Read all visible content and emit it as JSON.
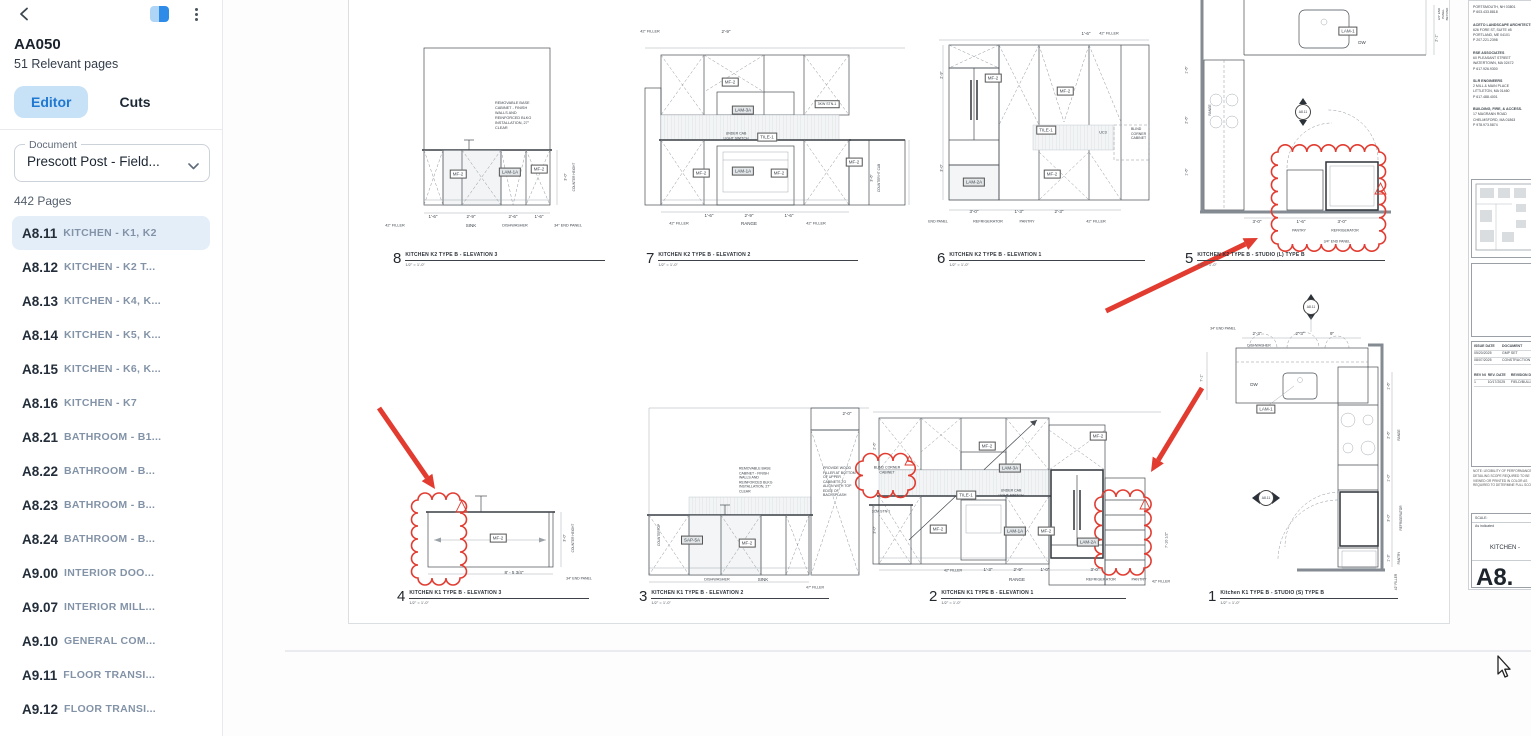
{
  "colors": {
    "accent": "#1f78d1",
    "tab_active_bg": "#c7e1f6",
    "selected_bg": "#e4eef9",
    "markup": "#e23b30",
    "line": "#464c52"
  },
  "sidebar": {
    "title": "AA050",
    "subtitle": "51 Relevant pages",
    "tabs": [
      {
        "label": "Editor",
        "active": true
      },
      {
        "label": "Cuts",
        "active": false
      }
    ],
    "document_label": "Document",
    "document_value": "Prescott Post - Field...",
    "pages_count": "442 Pages",
    "items": [
      {
        "code": "A8.11",
        "title": "KITCHEN - K1, K2",
        "selected": true
      },
      {
        "code": "A8.12",
        "title": "KITCHEN - K2 T...",
        "selected": false
      },
      {
        "code": "A8.13",
        "title": "KITCHEN - K4, K...",
        "selected": false
      },
      {
        "code": "A8.14",
        "title": "KITCHEN - K5, K...",
        "selected": false
      },
      {
        "code": "A8.15",
        "title": "KITCHEN - K6, K...",
        "selected": false
      },
      {
        "code": "A8.16",
        "title": "KITCHEN - K7",
        "selected": false
      },
      {
        "code": "A8.21",
        "title": "BATHROOM - B1...",
        "selected": false
      },
      {
        "code": "A8.22",
        "title": "BATHROOM - B...",
        "selected": false
      },
      {
        "code": "A8.23",
        "title": "BATHROOM - B...",
        "selected": false
      },
      {
        "code": "A8.24",
        "title": "BATHROOM - B...",
        "selected": false
      },
      {
        "code": "A9.00",
        "title": "INTERIOR DOO...",
        "selected": false
      },
      {
        "code": "A9.07",
        "title": "INTERIOR MILL...",
        "selected": false
      },
      {
        "code": "A9.10",
        "title": "GENERAL COM...",
        "selected": false
      },
      {
        "code": "A9.11",
        "title": "FLOOR TRANSI...",
        "selected": false
      },
      {
        "code": "A9.12",
        "title": "FLOOR TRANSI...",
        "selected": false
      },
      {
        "code": "A9.20",
        "title": "INTERIOR DET...",
        "selected": false
      }
    ]
  },
  "sheet": {
    "panels": [
      {
        "num": "8",
        "title": "KITCHEN K2 TYPE B - ELEVATION 3",
        "scale": "1/2\" = 1'-0\"",
        "x": 44,
        "y": 252,
        "w": 200
      },
      {
        "num": "7",
        "title": "KITCHEN K2 TYPE B - ELEVATION 2",
        "scale": "1/2\" = 1'-0\"",
        "x": 297,
        "y": 252,
        "w": 200
      },
      {
        "num": "6",
        "title": "KITCHEN K2 TYPE B - ELEVATION 1",
        "scale": "1/2\" = 1'-0\"",
        "x": 588,
        "y": 252,
        "w": 196
      },
      {
        "num": "5",
        "title": "KITCHEN K2 TYPE B - STUDIO (L) TYPE B",
        "scale": "1/2\" = 1'-0\"",
        "x": 836,
        "y": 252,
        "w": 188
      },
      {
        "num": "4",
        "title": "KITCHEN K1 TYPE B - ELEVATION 3",
        "scale": "1/2\" = 1'-0\"",
        "x": 48,
        "y": 590,
        "w": 180
      },
      {
        "num": "3",
        "title": "KITCHEN K1 TYPE B - ELEVATION 2",
        "scale": "1/2\" = 1'-0\"",
        "x": 290,
        "y": 590,
        "w": 178
      },
      {
        "num": "2",
        "title": "KITCHEN K1 TYPE B - ELEVATION 1",
        "scale": "1/2\" = 1'-0\"",
        "x": 580,
        "y": 590,
        "w": 185
      },
      {
        "num": "1",
        "title": "Kitchen K1 TYPE B - STUDIO (S) TYPE B",
        "scale": "1/2\" = 1'-0\"",
        "x": 859,
        "y": 590,
        "w": 178
      }
    ],
    "annotations": [
      {
        "t": "REMOVABLE BASE\nCABINET - FINISH\nWALLS AND\nREINFORCED BLKG\nINSTALLATION, 27\"\nCLEAR",
        "x": 146,
        "y": 116,
        "f": 3.8,
        "a": "l"
      },
      {
        "t": "MF-2",
        "x": 109,
        "y": 174,
        "b": 1
      },
      {
        "t": "LAM-1A",
        "x": 161,
        "y": 172,
        "b": 1,
        "g": 1
      },
      {
        "t": "MF-2",
        "x": 190,
        "y": 169,
        "b": 1
      },
      {
        "t": "1'-6\"",
        "x": 84,
        "y": 217
      },
      {
        "t": "2'-9\"",
        "x": 122,
        "y": 217
      },
      {
        "t": "2'-6\"",
        "x": 164,
        "y": 217
      },
      {
        "t": "1'-6\"",
        "x": 190,
        "y": 217
      },
      {
        "t": "42\" FILLER",
        "x": 46,
        "y": 226,
        "f": 3.8
      },
      {
        "t": "SINK",
        "x": 122,
        "y": 226
      },
      {
        "t": "DISHWASHER",
        "x": 166,
        "y": 226,
        "f": 3.8
      },
      {
        "t": "34\" END PANEL",
        "x": 219,
        "y": 226,
        "f": 3.8
      },
      {
        "t": "COUNTER HEIGHT",
        "x": 225,
        "y": 177,
        "r": -90,
        "f": 3.2
      },
      {
        "t": "3'-0\"",
        "x": 217,
        "y": 177,
        "r": -90,
        "f": 3.8
      },
      {
        "t": "42\" FILLER",
        "x": 301,
        "y": 32,
        "f": 3.8
      },
      {
        "t": "2'-9\"",
        "x": 377,
        "y": 32
      },
      {
        "t": "MF-2",
        "x": 381,
        "y": 82,
        "b": 1
      },
      {
        "t": "LAM-3A",
        "x": 394,
        "y": 110,
        "b": 1,
        "g": 1
      },
      {
        "t": "3KW\nSTN-1",
        "x": 478,
        "y": 104,
        "b": 1,
        "f": 3.5
      },
      {
        "t": "UNDER CAB\nLIGHT SWITCH",
        "x": 387,
        "y": 136,
        "f": 3.5
      },
      {
        "t": "TILE-1",
        "x": 418,
        "y": 137,
        "b": 1
      },
      {
        "t": "MF-2",
        "x": 352,
        "y": 173,
        "b": 1
      },
      {
        "t": "LAM-1A",
        "x": 394,
        "y": 171,
        "b": 1,
        "g": 1
      },
      {
        "t": "MF-2",
        "x": 430,
        "y": 173,
        "b": 1
      },
      {
        "t": "MF-2",
        "x": 505,
        "y": 162,
        "b": 1
      },
      {
        "t": "1'-6\"",
        "x": 360,
        "y": 216
      },
      {
        "t": "2'-9\"",
        "x": 400,
        "y": 216
      },
      {
        "t": "1'-6\"",
        "x": 440,
        "y": 216
      },
      {
        "t": "42\" FILLER",
        "x": 330,
        "y": 224,
        "f": 3.8
      },
      {
        "t": "RANGE",
        "x": 400,
        "y": 224
      },
      {
        "t": "42\" FILLER",
        "x": 467,
        "y": 224,
        "f": 3.8
      },
      {
        "t": "COUNTER HT CAB",
        "x": 530,
        "y": 178,
        "r": -90,
        "f": 3.2
      },
      {
        "t": "3'-6\"",
        "x": 523,
        "y": 178,
        "r": -90,
        "f": 3.8
      },
      {
        "t": "1'-6\"",
        "x": 737,
        "y": 34
      },
      {
        "t": "42\" FILLER",
        "x": 760,
        "y": 34,
        "f": 3.8
      },
      {
        "t": "MF-2",
        "x": 644,
        "y": 78,
        "b": 1
      },
      {
        "t": "MF-2",
        "x": 716,
        "y": 91,
        "b": 1
      },
      {
        "t": "TILE-1",
        "x": 697,
        "y": 130,
        "b": 1
      },
      {
        "t": "UC3",
        "x": 754,
        "y": 133,
        "f": 3.8
      },
      {
        "t": "BLIND\nCORNER\nCABINET",
        "x": 782,
        "y": 134,
        "f": 3.5,
        "a": "l"
      },
      {
        "t": "MF-2",
        "x": 703,
        "y": 174,
        "b": 1
      },
      {
        "t": "LAM-2A",
        "x": 625,
        "y": 182,
        "b": 1,
        "g": 1
      },
      {
        "t": "3'-0\"",
        "x": 625,
        "y": 212
      },
      {
        "t": "1'-3\"",
        "x": 670,
        "y": 212
      },
      {
        "t": "2'-3\"",
        "x": 710,
        "y": 212
      },
      {
        "t": "END PANEL",
        "x": 589,
        "y": 222,
        "f": 3.5
      },
      {
        "t": "REFRIGERATOR",
        "x": 639,
        "y": 222,
        "f": 3.8
      },
      {
        "t": "PANTRY",
        "x": 678,
        "y": 222,
        "f": 3.8
      },
      {
        "t": "42\" FILLER",
        "x": 747,
        "y": 222,
        "f": 3.8
      },
      {
        "t": "2'-9\"",
        "x": 593,
        "y": 75,
        "r": -90,
        "f": 3.8
      },
      {
        "t": "3'-0\"",
        "x": 593,
        "y": 168,
        "r": -90,
        "f": 3.8
      },
      {
        "t": "LAM-1",
        "x": 999,
        "y": 31,
        "b": 1
      },
      {
        "t": "DW",
        "x": 1013,
        "y": 43
      },
      {
        "t": "A8.11",
        "x": 954,
        "y": 112,
        "c": 1
      },
      {
        "t": "RANGE",
        "x": 861,
        "y": 110,
        "r": -90,
        "f": 3.2
      },
      {
        "t": "3'-0\"",
        "x": 908,
        "y": 222
      },
      {
        "t": "1'-6\"",
        "x": 952,
        "y": 222
      },
      {
        "t": "3'-0\"",
        "x": 993,
        "y": 222
      },
      {
        "t": "PANTRY",
        "x": 950,
        "y": 231,
        "f": 3.5
      },
      {
        "t": "REFRIGERATOR",
        "x": 996,
        "y": 231,
        "f": 3.5
      },
      {
        "t": "3/4\" END PANEL",
        "x": 988,
        "y": 242,
        "f": 3.5
      },
      {
        "t": "2'-1\"",
        "x": 1088,
        "y": 38,
        "r": -90,
        "f": 3.8
      },
      {
        "t": "3/4\" END PANEL\nBEYOND",
        "x": 1095,
        "y": 14,
        "r": -90,
        "f": 3
      },
      {
        "t": "1'-6\"",
        "x": 838,
        "y": 70,
        "r": -90,
        "f": 3.8
      },
      {
        "t": "2'-6\"",
        "x": 838,
        "y": 120,
        "r": -90,
        "f": 3.8
      },
      {
        "t": "1'-6\"",
        "x": 838,
        "y": 172,
        "r": -90,
        "f": 3.8
      },
      {
        "t": "MF-2",
        "x": 149,
        "y": 538,
        "b": 1
      },
      {
        "t": "8' - 5 3/4\"",
        "x": 165,
        "y": 573
      },
      {
        "t": "34\" END PANEL",
        "x": 230,
        "y": 579,
        "f": 3.5
      },
      {
        "t": "COUNTER HEIGHT",
        "x": 224,
        "y": 538,
        "r": -90,
        "f": 3.2
      },
      {
        "t": "3'-0\"",
        "x": 216,
        "y": 538,
        "r": -90,
        "f": 3.8
      },
      {
        "t": "REMOVABLE BASE\nCABINET - FINISH\nWALLS AND\nREINFORCED BLKG\nINSTALLATION, 27\"\nCLEAR",
        "x": 390,
        "y": 480,
        "f": 3.5,
        "a": "l"
      },
      {
        "t": "PROVIDE WOOD\nFILLER AT BOTTOM\nOF UPPER\nCABINETS TO\nALIGN WITH TOP\nEDGE OF\nBACKSPLASH",
        "x": 474,
        "y": 482,
        "f": 3.5,
        "a": "l"
      },
      {
        "t": "SAP-5A",
        "x": 343,
        "y": 540,
        "b": 1,
        "g": 1
      },
      {
        "t": "MF-2",
        "x": 398,
        "y": 543,
        "b": 1
      },
      {
        "t": "DISHWASHER",
        "x": 368,
        "y": 580,
        "f": 3.8
      },
      {
        "t": "SINK",
        "x": 414,
        "y": 580
      },
      {
        "t": "COUNTERTOP",
        "x": 310,
        "y": 535,
        "r": -90,
        "f": 3.2
      },
      {
        "t": "47\" FILLER",
        "x": 466,
        "y": 588,
        "f": 3.5
      },
      {
        "t": "2'-0\"",
        "x": 498,
        "y": 414
      },
      {
        "t": "BLIND CORNER\nCABINET",
        "x": 538,
        "y": 470,
        "f": 3.5
      },
      {
        "t": "MF-2",
        "x": 638,
        "y": 446,
        "b": 1
      },
      {
        "t": "MF-2",
        "x": 749,
        "y": 436,
        "b": 1
      },
      {
        "t": "LAM-3A",
        "x": 661,
        "y": 468,
        "b": 1,
        "g": 1
      },
      {
        "t": "TILE-1",
        "x": 617,
        "y": 495,
        "b": 1
      },
      {
        "t": "UNDER CAB\nLIGHT SWITCH",
        "x": 662,
        "y": 493,
        "f": 3.5
      },
      {
        "t": "3CM STN-1",
        "x": 532,
        "y": 512,
        "f": 3.5
      },
      {
        "t": "MF-2",
        "x": 589,
        "y": 529,
        "b": 1
      },
      {
        "t": "LAM-1A",
        "x": 666,
        "y": 531,
        "b": 1,
        "g": 1
      },
      {
        "t": "MF-2",
        "x": 697,
        "y": 531,
        "b": 1
      },
      {
        "t": "LAM-2A",
        "x": 739,
        "y": 542,
        "b": 1,
        "g": 1
      },
      {
        "t": "42\" FILLER",
        "x": 604,
        "y": 571,
        "f": 3.5
      },
      {
        "t": "1'-3\"",
        "x": 639,
        "y": 570
      },
      {
        "t": "2'-9\"",
        "x": 669,
        "y": 570
      },
      {
        "t": "1'-0\"",
        "x": 696,
        "y": 570
      },
      {
        "t": "3'-0\"",
        "x": 746,
        "y": 570
      },
      {
        "t": "RANGE",
        "x": 668,
        "y": 580
      },
      {
        "t": "REFRIGERATOR",
        "x": 752,
        "y": 580,
        "f": 3.8
      },
      {
        "t": "PANTRY",
        "x": 790,
        "y": 580,
        "f": 3.8
      },
      {
        "t": "42\" FILLER",
        "x": 812,
        "y": 582,
        "f": 3.5
      },
      {
        "t": "7'-10 1/2\"",
        "x": 818,
        "y": 540,
        "r": -90,
        "f": 3.8
      },
      {
        "t": "2'-6\"",
        "x": 526,
        "y": 446,
        "r": -90,
        "f": 3.8
      },
      {
        "t": "3'-0\"",
        "x": 526,
        "y": 530,
        "r": -90,
        "f": 3.8
      },
      {
        "t": "A8.11",
        "x": 962,
        "y": 307,
        "c": 1
      },
      {
        "t": "34\" END PANEL",
        "x": 874,
        "y": 329,
        "f": 3.5
      },
      {
        "t": "2'-3\"",
        "x": 908,
        "y": 334
      },
      {
        "t": "2'-3\"",
        "x": 951,
        "y": 334
      },
      {
        "t": "9\"",
        "x": 983,
        "y": 334
      },
      {
        "t": "DISHWASHER",
        "x": 910,
        "y": 346,
        "f": 3.5
      },
      {
        "t": "DW",
        "x": 905,
        "y": 385
      },
      {
        "t": "LAM-1",
        "x": 917,
        "y": 409,
        "b": 1
      },
      {
        "t": "A8.11",
        "x": 917,
        "y": 498,
        "c": 1
      },
      {
        "t": "7'-1\"",
        "x": 853,
        "y": 378,
        "r": -90,
        "f": 3.8
      },
      {
        "t": "1'-6\"",
        "x": 1040,
        "y": 386,
        "r": -90,
        "f": 3.8
      },
      {
        "t": "2'-6\"",
        "x": 1040,
        "y": 435,
        "r": -90,
        "f": 3.8
      },
      {
        "t": "1'-0\"",
        "x": 1040,
        "y": 478,
        "r": -90,
        "f": 3.8
      },
      {
        "t": "3'-0\"",
        "x": 1040,
        "y": 518,
        "r": -90,
        "f": 3.8
      },
      {
        "t": "1'-3\"",
        "x": 1040,
        "y": 558,
        "r": -90,
        "f": 3.8
      },
      {
        "t": "RANGE",
        "x": 1050,
        "y": 435,
        "r": -90,
        "f": 3.2
      },
      {
        "t": "REFRIGERATOR",
        "x": 1052,
        "y": 518,
        "r": -90,
        "f": 3.2
      },
      {
        "t": "PANTRY",
        "x": 1050,
        "y": 558,
        "r": -90,
        "f": 3.2
      },
      {
        "t": "42\" FILLER",
        "x": 1047,
        "y": 582,
        "r": -90,
        "f": 3.2
      }
    ],
    "markups": [
      {
        "type": "arrow",
        "x1": 30,
        "y1": 408,
        "x2": 86,
        "y2": 489
      },
      {
        "type": "cloud",
        "x": 69,
        "y": 500,
        "w": 42,
        "h": 78
      },
      {
        "type": "tri",
        "x": 107,
        "y": 501,
        "s": 11
      },
      {
        "type": "arrow",
        "x1": 757,
        "y1": 311,
        "x2": 909,
        "y2": 238
      },
      {
        "type": "cloud",
        "x": 929,
        "y": 152,
        "w": 101,
        "h": 92
      },
      {
        "type": "tri",
        "x": 1026,
        "y": 183,
        "s": 11
      },
      {
        "type": "arrow",
        "x1": 853,
        "y1": 388,
        "x2": 802,
        "y2": 472
      },
      {
        "type": "cloud",
        "x": 753,
        "y": 497,
        "w": 42,
        "h": 71
      },
      {
        "type": "tri",
        "x": 791,
        "y": 499,
        "s": 10
      },
      {
        "type": "cloud",
        "x": 514,
        "y": 461,
        "w": 45,
        "h": 29
      },
      {
        "type": "tri",
        "x": 556,
        "y": 456,
        "s": 9
      }
    ]
  },
  "titleblock": {
    "consultants": [
      {
        "name": "",
        "lines": [
          "PORTSMOUTH, NH 03801",
          "P 603.433.8818"
        ]
      },
      {
        "name": "ACETO LANDSCAPE ARCHITECTS",
        "lines": [
          "626 FORE ST, SUITE #5",
          "PORTLAND, ME 04101",
          "P 207.221.2398"
        ]
      },
      {
        "name": "RSE ASSOCIATES",
        "lines": [
          "60 PLEASANT STREET",
          "WATERTOWN, MA 02472",
          "P 617.926.9300"
        ]
      },
      {
        "name": "SLR ENGINEERS",
        "lines": [
          "2 MILL & MAIN PLACE",
          "LITTLETON, MA 01460",
          "P 617.488.4001"
        ]
      },
      {
        "name": "BUILDING, FIRE, & ACCESS.",
        "lines": [
          "17 MAGRANN ROAD",
          "CHELMSFORD, MA 01863",
          "P 978.973.5874"
        ]
      }
    ],
    "issue_headers": [
      "ISSUE DATE",
      "DOCUMENT"
    ],
    "issue_rows": [
      [
        "05/20/2025",
        "GMP SET"
      ],
      [
        "08/07/2025",
        "CONSTRUCTION"
      ]
    ],
    "rev_headers": [
      "REV NO.",
      "REV. DATE",
      "REVISION DESC"
    ],
    "rev_rows": [
      [
        "1",
        "10/17/2025",
        "FIELD/BULLETIN"
      ]
    ],
    "note": "NOTE: LEGIBILITY OF PERFORMANCE DETAILING SCOPE REQUIRED TO BE VIEWED OR PRINTED IN COLOR AS REQUIRED TO DETERMINE FULL SCOPE",
    "scale_label": "SCALE:",
    "scale_value": "As indicated",
    "sheet_title": "KITCHEN -",
    "sheet_number": "A8."
  }
}
